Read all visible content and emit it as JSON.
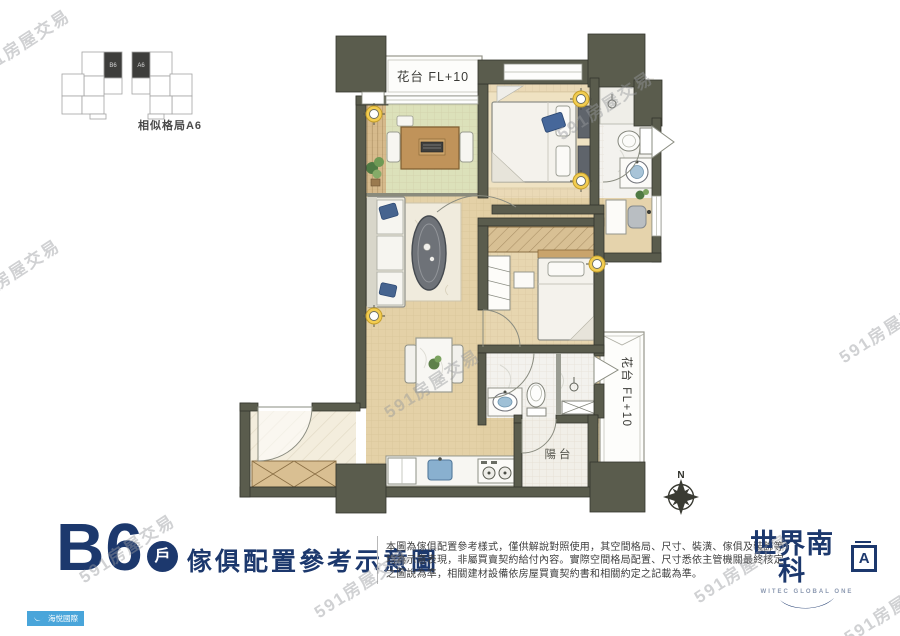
{
  "watermark": {
    "text": "591房屋交易"
  },
  "key_plan": {
    "caption": "相似格局A6",
    "left_highlight_label": "B6",
    "right_highlight_label": "A6"
  },
  "plan_labels": {
    "terrace_top": "花台 FL+10",
    "terrace_right": "花台 FL+10",
    "balcony": "陽台",
    "north": "N"
  },
  "title_block": {
    "unit": "B6",
    "unit_type": "戶",
    "heading": "傢俱配置參考示意圖",
    "disclaimer": [
      "本圖為傢俱配置參考樣式，僅供解說對照使用，其空間格局、尺寸、裝潢、傢俱及裝飾等",
      "均為示意表現，非屬買賣契約給付內容。實際空間格局配置、尺寸悉依主管機關最終核定",
      "之圖說為準，相關建材設備依房屋買賣契約書和相關約定之記載為準。"
    ]
  },
  "brand": {
    "name": "世界南科",
    "badge": "A",
    "tagline": "WITEC GLOBAL ONE",
    "publisher": "海悅國際"
  },
  "colors": {
    "navy": "#1c386d",
    "wall": "#5a5c4d",
    "accent_blue": "#49a5da"
  }
}
